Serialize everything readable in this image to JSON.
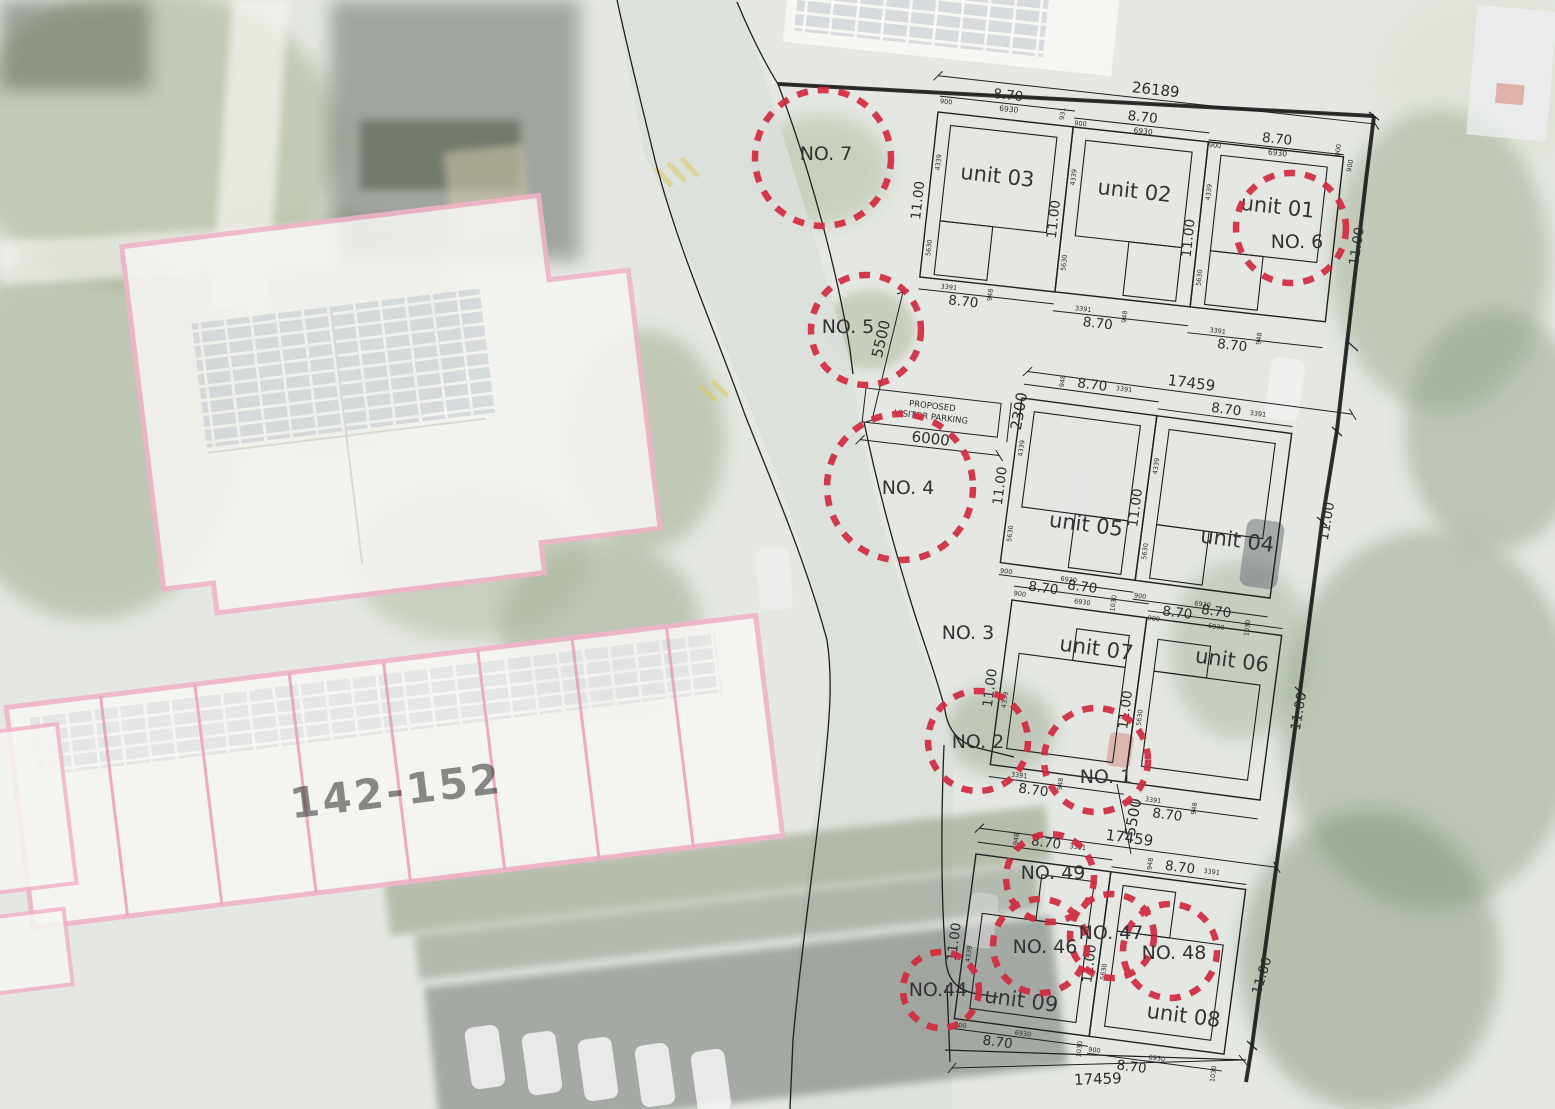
{
  "colors": {
    "tree_marker_red": "#d2293e",
    "boundary_pink": "#f0a9c2",
    "plan_line": "#202020"
  },
  "units": [
    {
      "label": "unit 01"
    },
    {
      "label": "unit 02"
    },
    {
      "label": "unit 03"
    },
    {
      "label": "unit 04"
    },
    {
      "label": "unit 05"
    },
    {
      "label": "unit 06"
    },
    {
      "label": "unit 07"
    },
    {
      "label": "unit 08"
    },
    {
      "label": "unit 09"
    }
  ],
  "trees": [
    {
      "label": "NO. 1"
    },
    {
      "label": "NO. 2"
    },
    {
      "label": "NO. 3"
    },
    {
      "label": "NO. 4"
    },
    {
      "label": "NO. 5"
    },
    {
      "label": "NO. 6"
    },
    {
      "label": "NO. 7"
    },
    {
      "label": "NO.44"
    },
    {
      "label": "NO. 46"
    },
    {
      "label": "NO. 47"
    },
    {
      "label": "NO. 48"
    },
    {
      "label": "NO. 49"
    }
  ],
  "dims": {
    "overall_width": "26189",
    "row_width": "17459",
    "gap_depth": "5500",
    "parking_width": "6000",
    "parking_depth": "2300",
    "plot_width": "8.70",
    "plot_depth": "11.00",
    "house_width": "6930",
    "side_offset": "900",
    "front_setback": "4339",
    "house_depth": "5630",
    "garage_width": "3391",
    "garage_offset": "948",
    "edge_strip": "931",
    "rear_strip": "1030"
  },
  "labels": {
    "parking_line1": "PROPOSED",
    "parking_line2": "VISITOR PARKING",
    "existing_building": "142-152"
  }
}
